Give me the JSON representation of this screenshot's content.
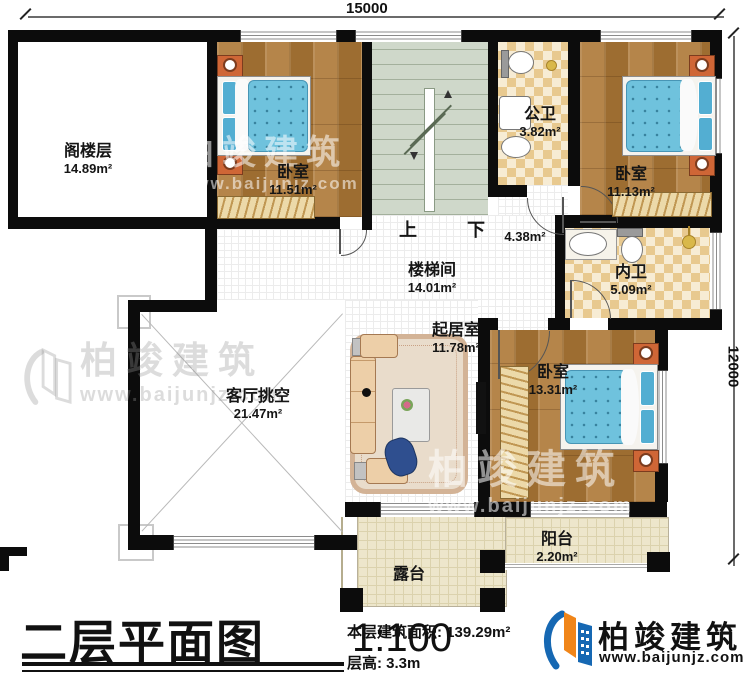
{
  "dims": {
    "top": "15000",
    "right": "12000"
  },
  "stairs": {
    "up": "上",
    "down": "下"
  },
  "rooms": {
    "attic": {
      "name": "阁楼层",
      "area": "14.89m²"
    },
    "bedroom1": {
      "name": "卧室",
      "area": "11.51m²"
    },
    "public_bath": {
      "name": "公卫",
      "area": "3.82m²"
    },
    "bedroom2": {
      "name": "卧室",
      "area": "11.13m²"
    },
    "stairwell": {
      "name": "楼梯间",
      "area": "14.01m²"
    },
    "corridor": {
      "area": "4.38m²"
    },
    "ensuite": {
      "name": "内卫",
      "area": "5.09m²"
    },
    "living": {
      "name": "起居室",
      "area": "11.78m²"
    },
    "void": {
      "name": "客厅挑空",
      "area": "21.47m²"
    },
    "bedroom3": {
      "name": "卧室",
      "area": "13.31m²"
    },
    "balcony": {
      "name": "阳台",
      "area": "2.20m²"
    },
    "terrace": {
      "name": "露台"
    }
  },
  "titlebar": {
    "title": "二层平面图",
    "scale": "1:100",
    "area_text": "本层建筑面积: 139.29m²",
    "height_text": "层高: 3.3m"
  },
  "brand": {
    "name": "柏竣建筑",
    "url": "www.baijunjz.com"
  },
  "watermark": {
    "name": "柏竣建筑",
    "url": "www.baijunjz.com"
  },
  "colors": {
    "wall": "#0c0c0c",
    "wood_floor": "#ac783c",
    "tile_checker": "#e8c98f",
    "stair_green": "#cfd8ca",
    "terrace_sand": "#ede6cb",
    "bed_blue": "#6fc2dd",
    "nightstand_orange": "#cf6636",
    "logo_blue": "#1668b3",
    "logo_orange": "#f08519"
  }
}
